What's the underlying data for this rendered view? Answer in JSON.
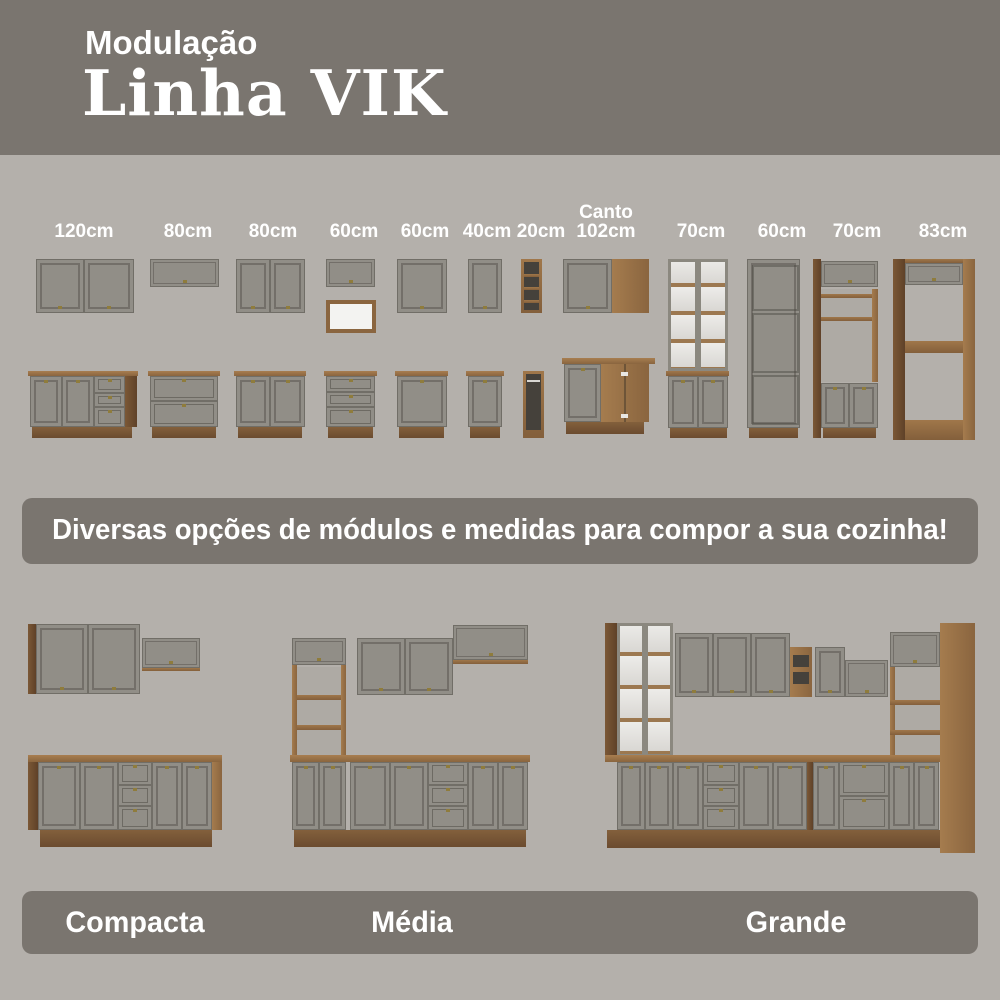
{
  "colors": {
    "background": "#b4b0ab",
    "banner": "#7a756f",
    "door_gray": "#918e87",
    "wood": "#8a653f",
    "text": "#ffffff"
  },
  "header": {
    "subtitle": "Modulação",
    "title": "Linha VIK"
  },
  "modules": {
    "items": [
      {
        "label": "120cm"
      },
      {
        "label": "80cm"
      },
      {
        "label": "80cm"
      },
      {
        "label": "60cm"
      },
      {
        "label": "60cm"
      },
      {
        "label": "40cm"
      },
      {
        "label": "20cm"
      },
      {
        "label": "Canto\n102cm"
      },
      {
        "label": "70cm"
      },
      {
        "label": "60cm"
      },
      {
        "label": "70cm"
      },
      {
        "label": "83cm"
      }
    ]
  },
  "banner": {
    "text": "Diversas opções de módulos e medidas para compor a sua cozinha!"
  },
  "kitchens": {
    "items": [
      {
        "name": "Compacta"
      },
      {
        "name": "Média"
      },
      {
        "name": "Grande"
      }
    ]
  }
}
